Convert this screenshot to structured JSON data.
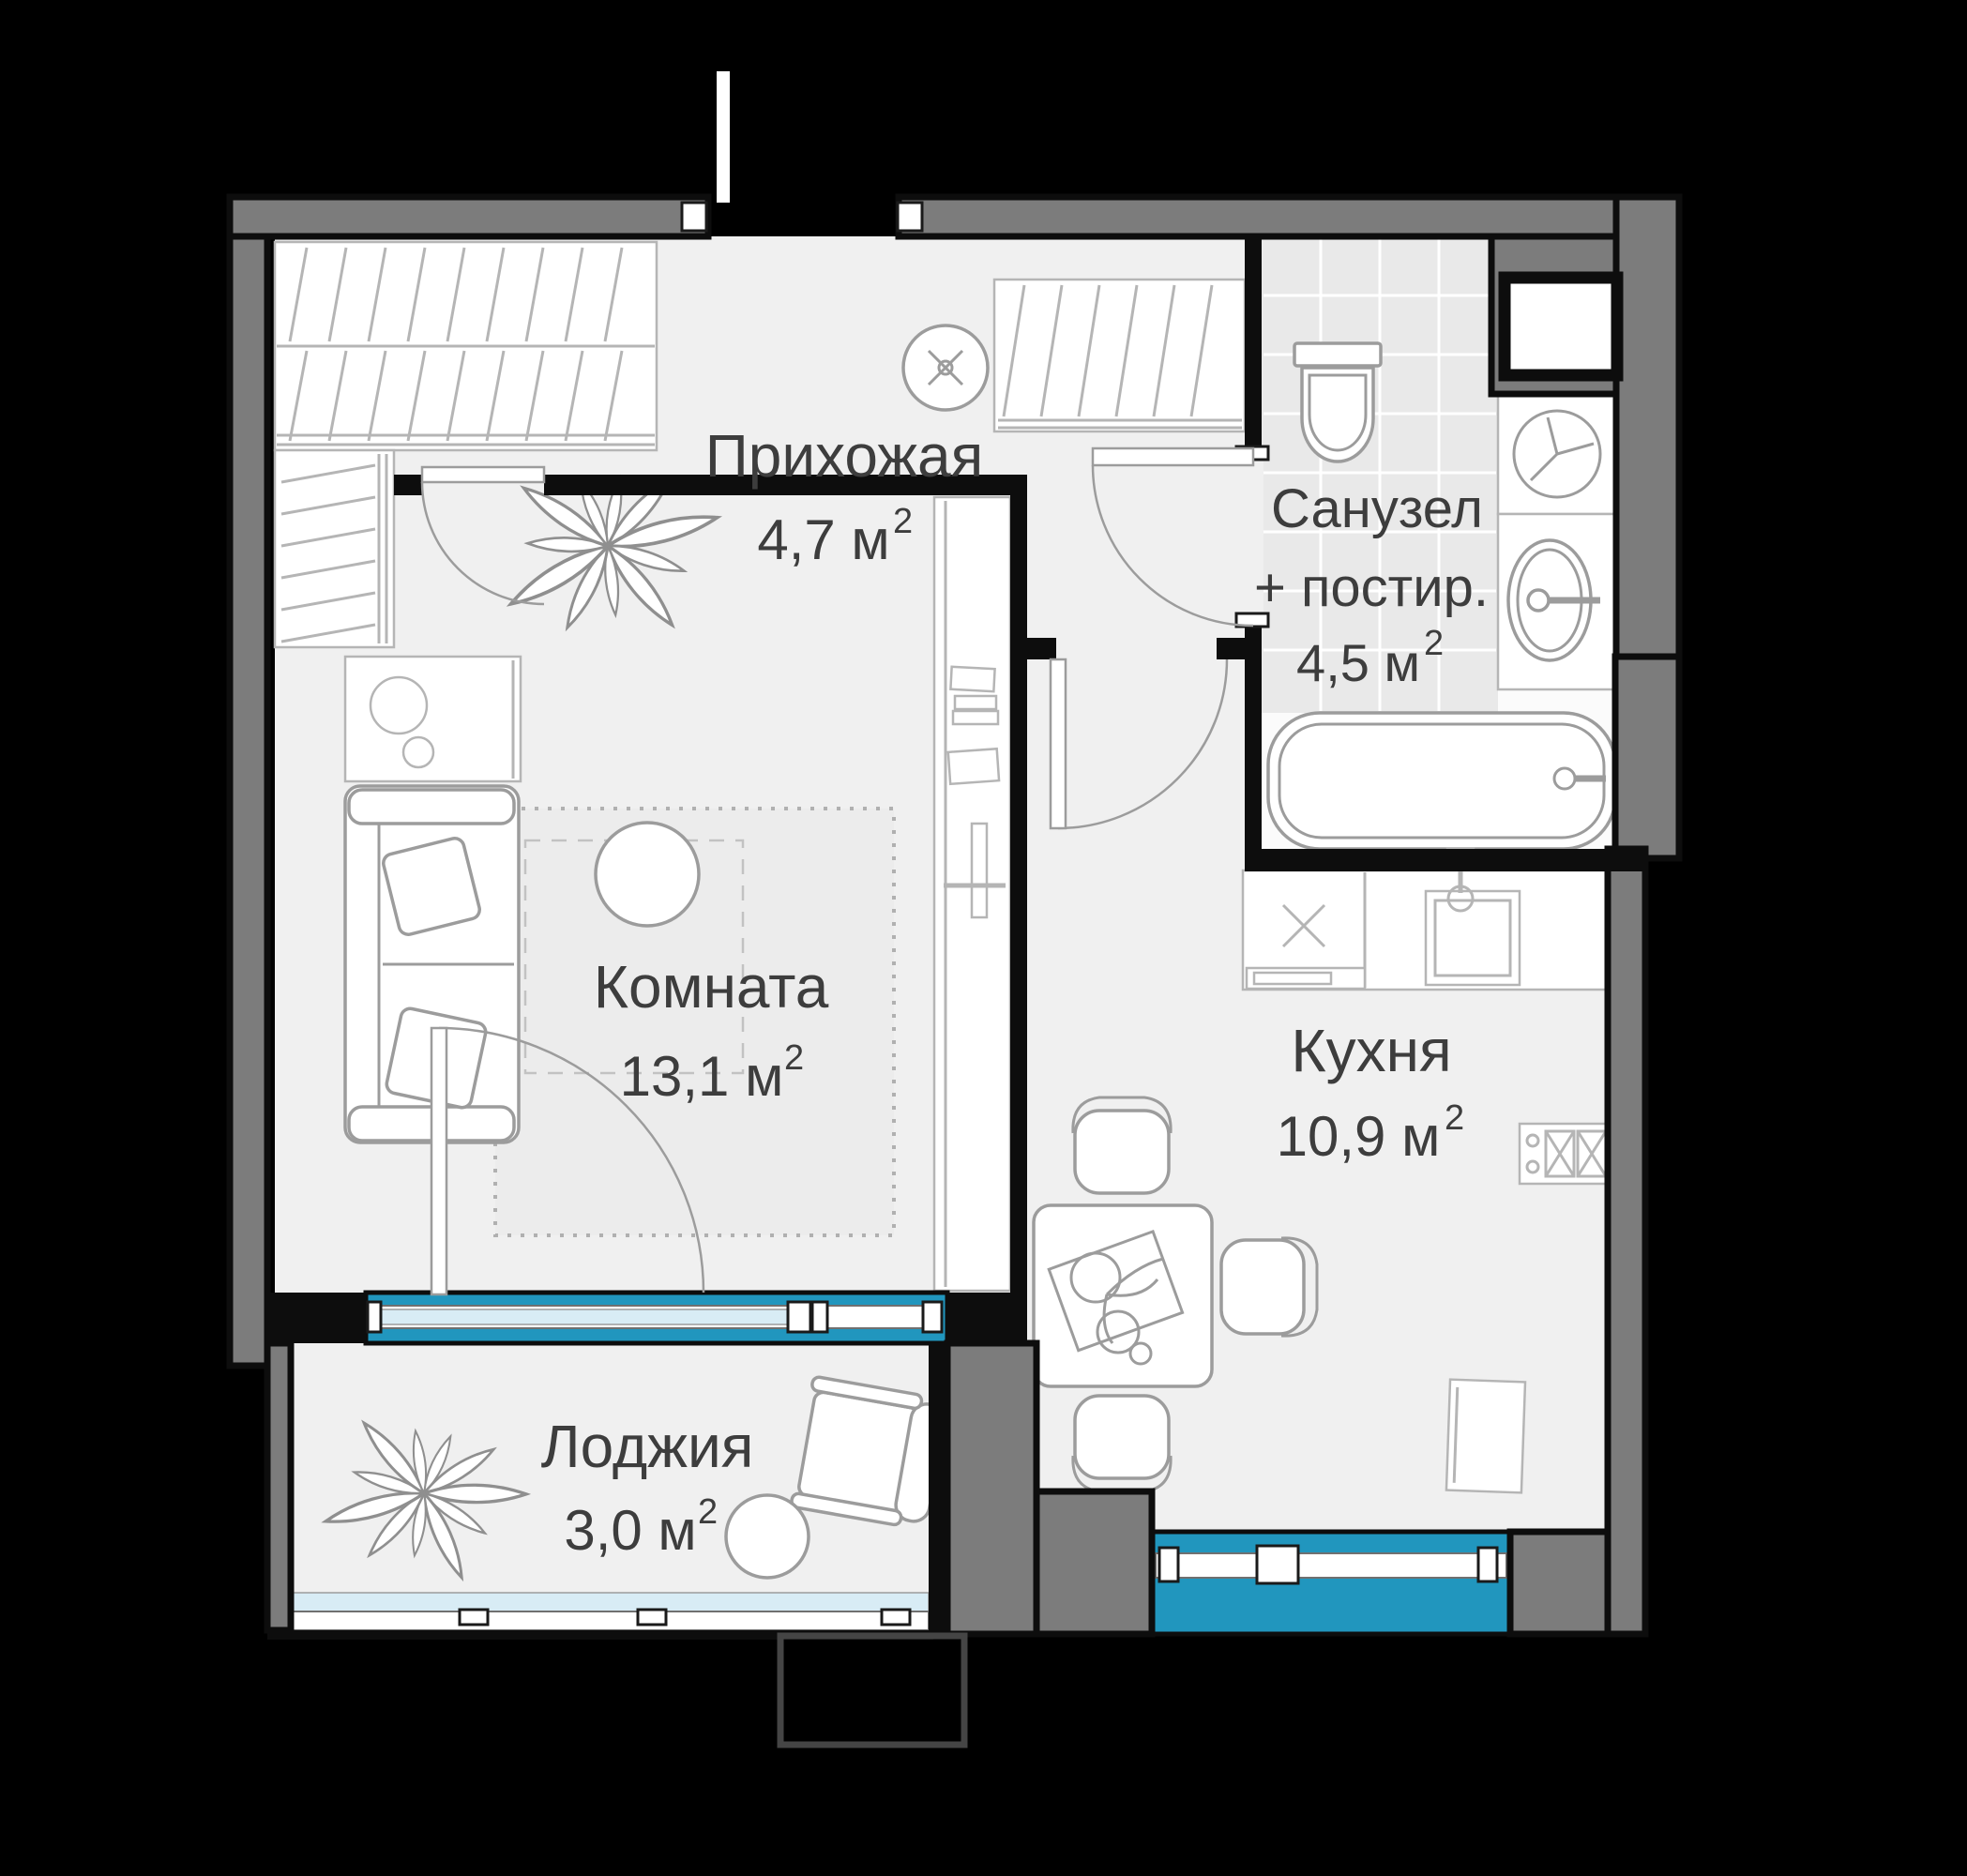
{
  "plan": {
    "type": "apartment-floor-plan",
    "language": "ru",
    "rooms": [
      {
        "key": "hallway",
        "name": "Прихожая",
        "area": "4,7 м",
        "area_sup": "2"
      },
      {
        "key": "bathroom",
        "name1": "Санузел",
        "name2": "+ постир.",
        "area": "4,5 м",
        "area_sup": "2"
      },
      {
        "key": "living-room",
        "name": "Комната",
        "area": "13,1 м",
        "area_sup": "2"
      },
      {
        "key": "kitchen",
        "name": "Кухня",
        "area": "10,9 м",
        "area_sup": "2"
      },
      {
        "key": "loggia",
        "name": "Лоджия",
        "area": "3,0 м",
        "area_sup": "2"
      }
    ],
    "fixtures": [
      "wardrobe-closet",
      "coat-closet",
      "linen-closet",
      "ceiling-fan",
      "entrance-door",
      "interior-door",
      "toilet",
      "washing-machine",
      "bathroom-sink",
      "bathtub",
      "ventilation-shaft",
      "kitchen-counter",
      "kitchen-sink",
      "cooktop",
      "kitchen-cabinet",
      "dining-table",
      "dining-chair",
      "sofa",
      "area-rug",
      "pouf",
      "tv-stand",
      "books",
      "plant",
      "balcony-door",
      "window",
      "loggia-glazing",
      "armchair",
      "loggia-table",
      "side-table"
    ],
    "colors": {
      "background": "#000000",
      "wall_fill": "#7c7c7c",
      "wall_outline": "#0d0d0d",
      "floor": "#f0f0f0",
      "tile_floor": "#e9e9e9",
      "furniture_line": "#9c9c9c",
      "window_accent": "#2196be",
      "glass": "#d8ecf5",
      "label_text": "#3d3d3d"
    }
  }
}
